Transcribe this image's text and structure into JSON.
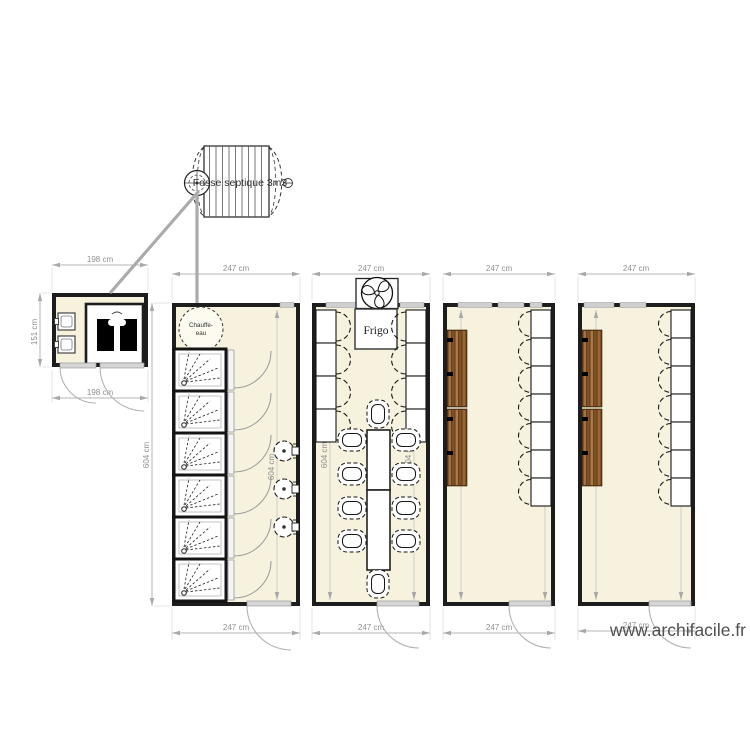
{
  "canvas": {
    "width": 750,
    "height": 750,
    "background": "#ffffff"
  },
  "watermark": {
    "text": "www.archifacile.fr"
  },
  "septic_tank": {
    "label": "Fosse septique 3m3"
  },
  "water_heater": {
    "line1": "Chauffe-",
    "line2": "eau"
  },
  "fridge": {
    "label": "Frigo"
  },
  "dims": {
    "small_room_top": "198 cm",
    "small_room_bottom": "198 cm",
    "small_room_left": "151 cm",
    "room1_top": "247 cm",
    "room2_top": "247 cm",
    "room3_top": "247 cm",
    "room4_top": "247 cm",
    "room1_bottom": "247 cm",
    "room2_bottom": "247 cm",
    "room3_bottom": "247 cm",
    "room4_bottom": "247 cm",
    "room1_left": "604 cm",
    "room1_right": "604 cm",
    "room2_left": "604 cm",
    "room2_right": "604 cm",
    "room3_left": "604 cm",
    "room3_right": "604 cm",
    "room4_left": "604 cm",
    "room4_right": "604 cm"
  },
  "colors": {
    "room_fill": "#f6f2dd",
    "wall": "#1d1d1d",
    "dim_line": "#b5b5b5",
    "dim_text": "#8f8f8f",
    "door": "#d6d6d6",
    "pipe": "#ababab",
    "wood_dark": "#6b431d",
    "wood_light": "#a06a33",
    "watermark": "#4f4f4f"
  }
}
